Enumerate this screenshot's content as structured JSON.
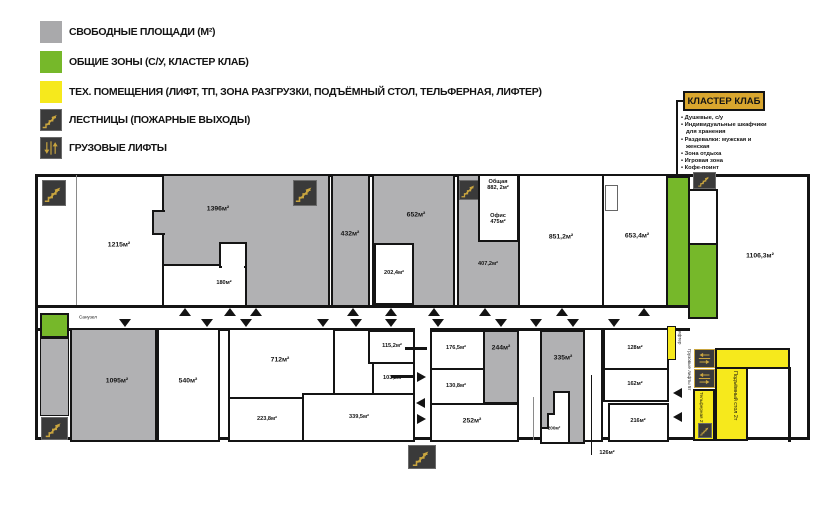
{
  "legend": {
    "items": [
      {
        "icon": "gray-swatch",
        "label": "СВОБОДНЫЕ ПЛОЩАДИ (М²)"
      },
      {
        "icon": "green-swatch",
        "label": "ОБЩИЕ ЗОНЫ (С/У, КЛАСТЕР КЛАБ)"
      },
      {
        "icon": "yellow-swatch",
        "label": "ТЕХ. ПОМЕЩЕНИЯ (ЛИФТ, ТП, ЗОНА РАЗГРУЗКИ, ПОДЪЁМНЫЙ СТОЛ, ТЕЛЬФЕРНАЯ, ЛИФТЕР)"
      },
      {
        "icon": "stairs-icon",
        "label": "ЛЕСТНИЦЫ (ПОЖАРНЫЕ ВЫХОДЫ)"
      },
      {
        "icon": "freight-lift-icon",
        "label": "ГРУЗОВЫЕ ЛИФТЫ"
      }
    ]
  },
  "cluster_club": {
    "title": "КЛАСТЕР КЛАБ",
    "bullets": [
      "Душевые, с/у",
      "Индивидуальные шкафчики для хранения",
      "Раздевалки: мужская и женская",
      "Зона отдыха",
      "Игровая зона",
      "Кофе-поинт"
    ]
  },
  "plan": {
    "corridor_label": "Санузел",
    "rooms": {
      "r1215": "1215м²",
      "r1396": "1396м²",
      "r180": "180м²",
      "r432": "432м²",
      "r652": "652м²",
      "r202": "202,4м²",
      "obshaya_line1": "Общая",
      "obshaya_line2": "882, 2м²",
      "office_line1": "Офис",
      "office_line2": "475м²",
      "r407": "407,2м²",
      "r851": "851,2м²",
      "r653": "653,4м²",
      "r1106": "1106,3м²",
      "r1095": "1095м²",
      "r540": "540м²",
      "r712": "712м²",
      "r223": "223,8м²",
      "r339": "339,5м²",
      "r115": "115,2м²",
      "r103": "103,2м²",
      "r176": "176,5м²",
      "r130": "130,8м²",
      "r244": "244м²",
      "r252": "252м²",
      "r335": "335м²",
      "r200": "200м²",
      "r126": "126м²",
      "r128": "128м²",
      "r162": "162м²",
      "r216": "216м²"
    },
    "tech": {
      "lifter": "Лифтер",
      "freight": "Грузовые лифты 5т",
      "telfer": "Тельферная 2т",
      "lift_table": "Подъёмный стол 2т"
    }
  },
  "colors": {
    "free_area": "#b1b1b3",
    "common_zone": "#76b82a",
    "tech_zone": "#f6e91c",
    "wall": "#141414",
    "cluster_label_bg": "#d9a62e",
    "stairs_stroke": "#c9a53f"
  }
}
